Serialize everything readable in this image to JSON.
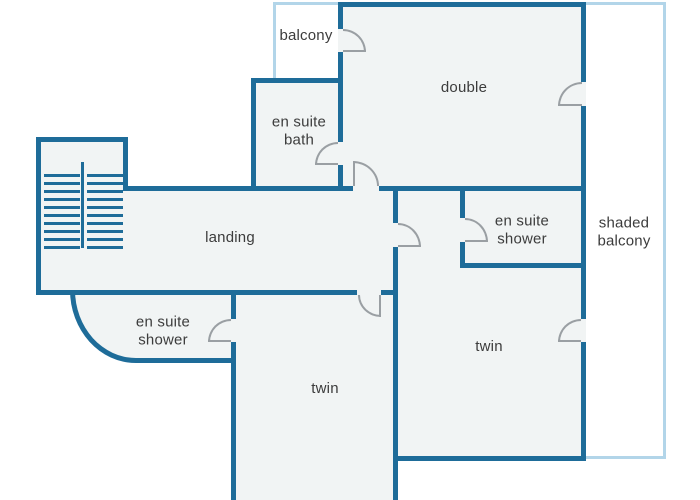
{
  "figure": {
    "type": "floor-plan",
    "subject": "first floor layout with bedrooms, en suites, landing, stairs and balconies"
  },
  "colors": {
    "wall": "#1e6c99",
    "light_outline": "#b2d5e9",
    "floor": "#f1f4f4",
    "door_arc": "#9a9fa3",
    "text": "#3c3c3c",
    "background": "#ffffff"
  },
  "rooms": [
    {
      "name": "balcony",
      "label": "balcony"
    },
    {
      "name": "double",
      "label": "double"
    },
    {
      "name": "en-suite-bath",
      "label": "en suite\nbath"
    },
    {
      "name": "en-suite-shower-upper",
      "label": "en suite\nshower"
    },
    {
      "name": "shaded-balcony",
      "label": "shaded\nbalcony"
    },
    {
      "name": "landing",
      "label": "landing"
    },
    {
      "name": "en-suite-shower-lower",
      "label": "en suite\nshower"
    },
    {
      "name": "twin-bottom",
      "label": "twin"
    },
    {
      "name": "twin-right",
      "label": "twin"
    }
  ],
  "stairs": {
    "flights": 2,
    "tread_count": 10
  },
  "door_count": 9
}
